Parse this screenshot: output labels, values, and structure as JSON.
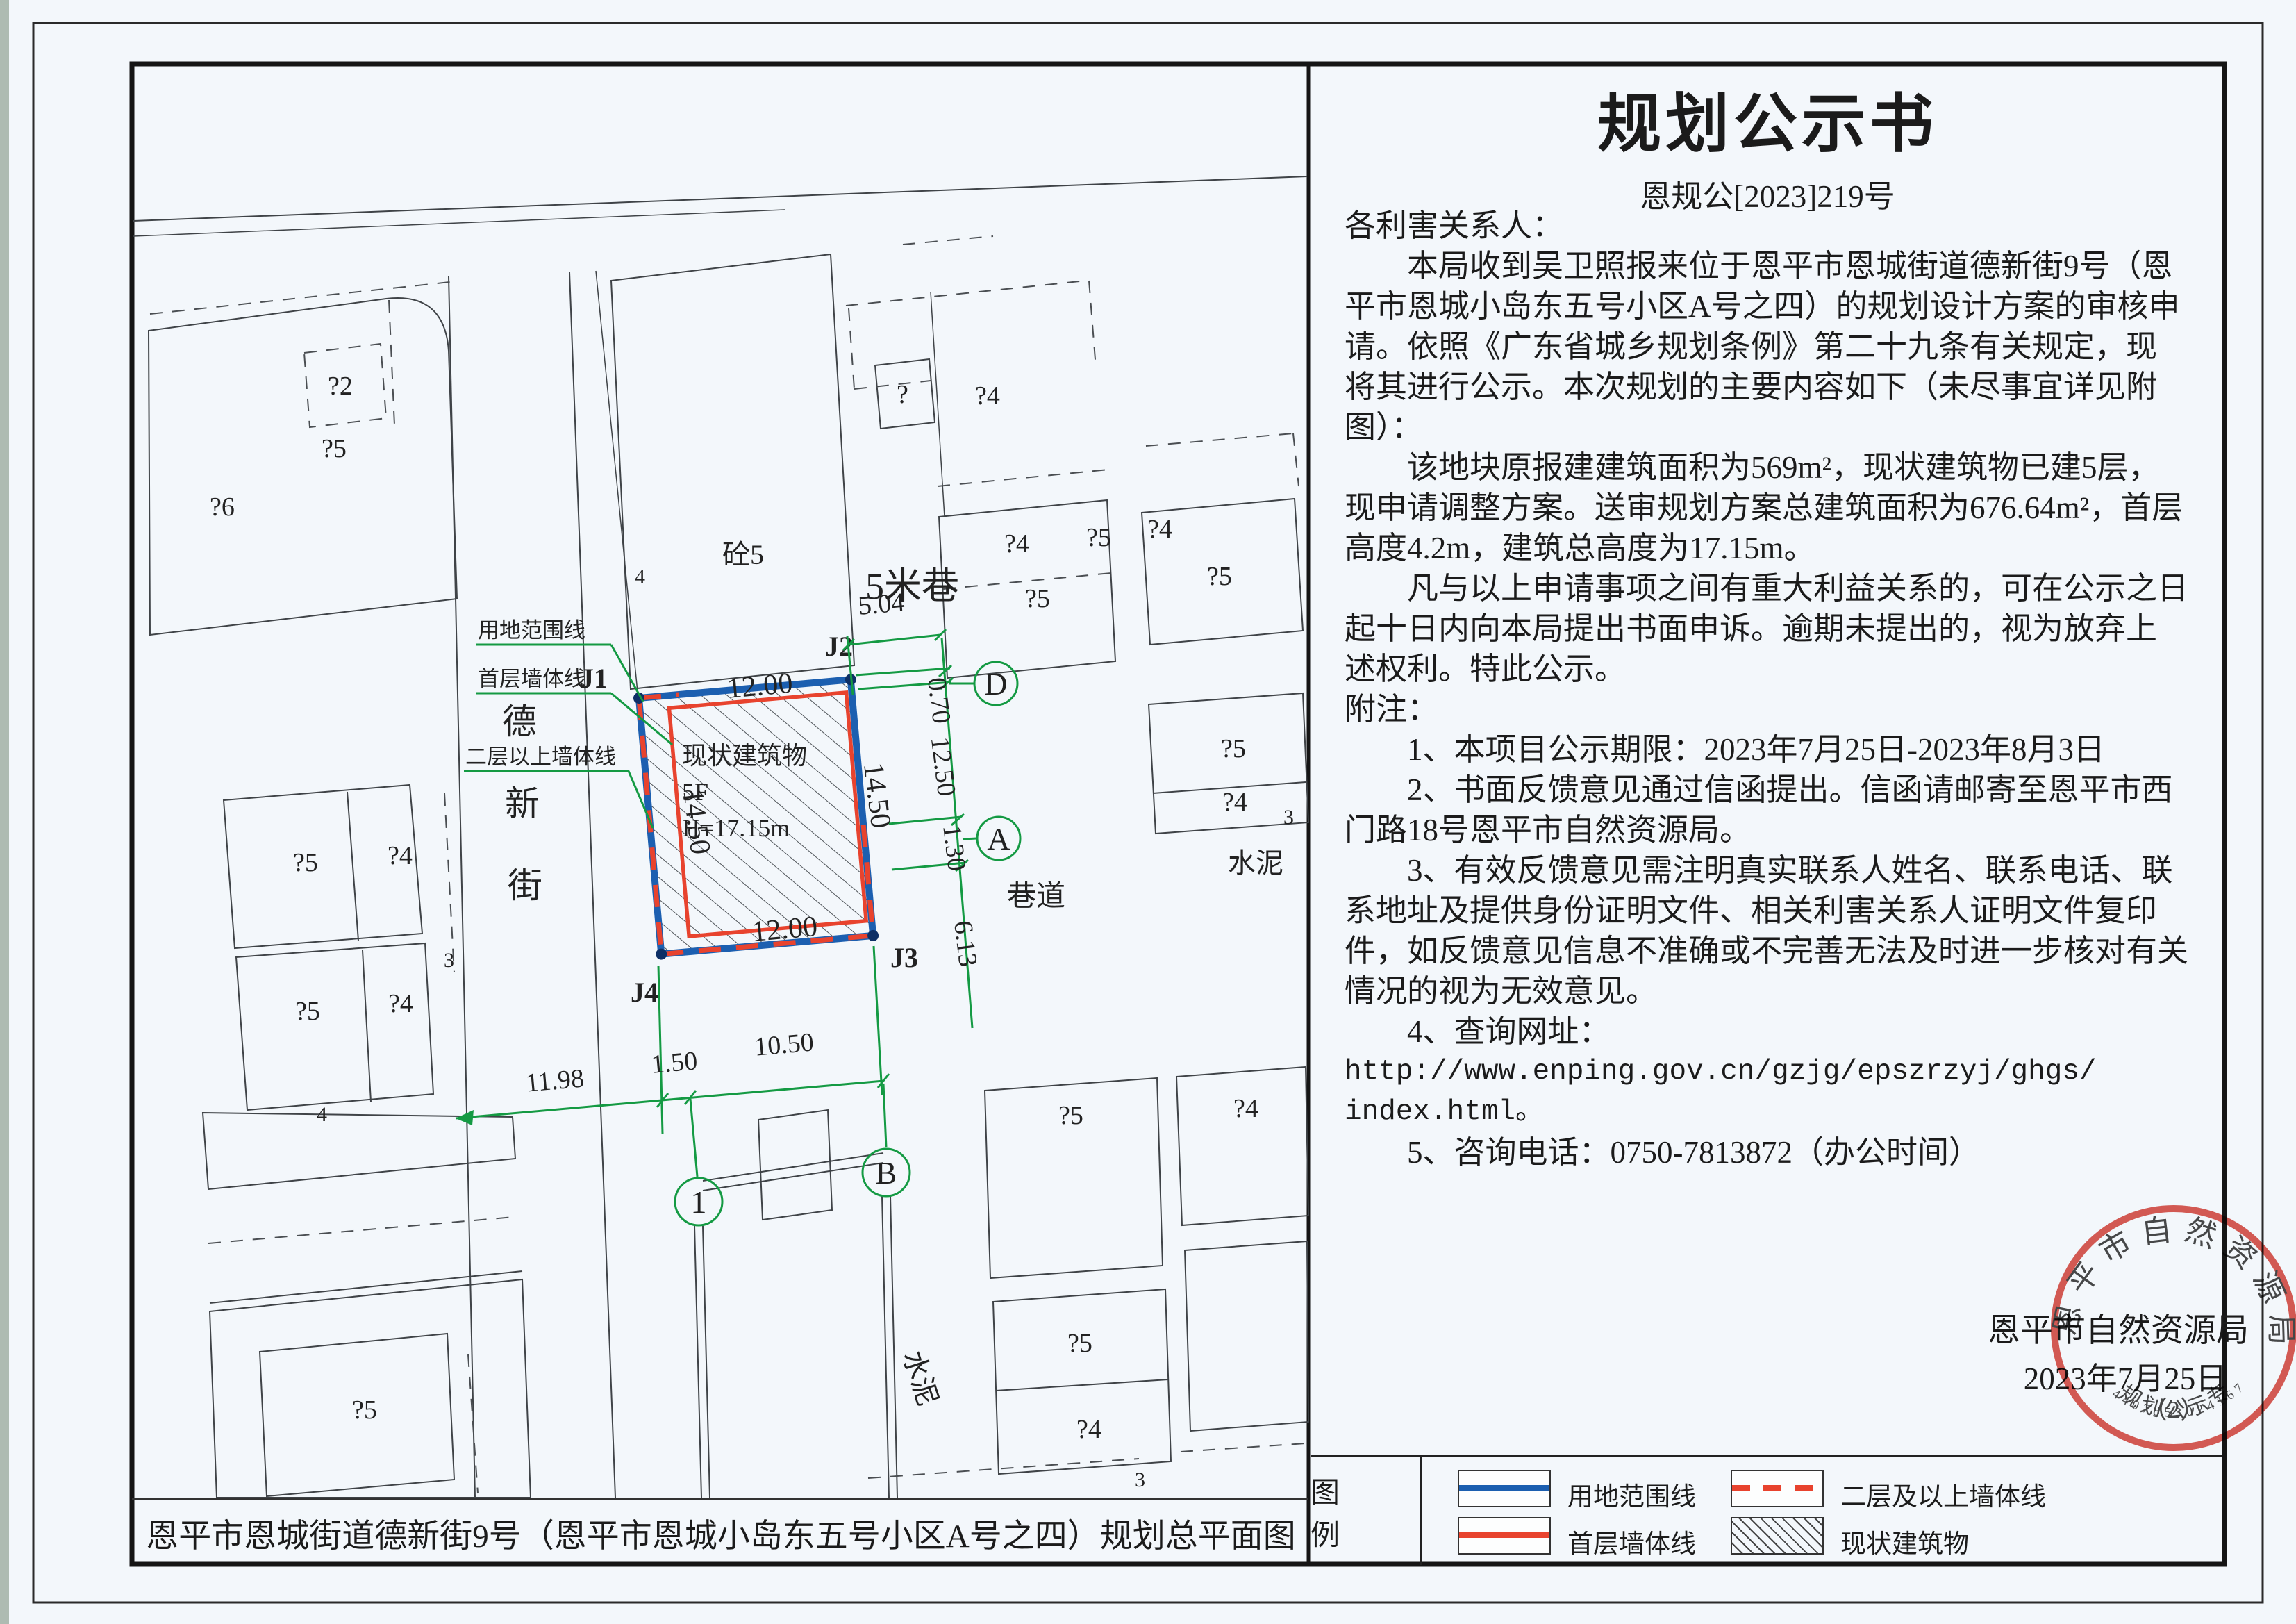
{
  "notice": {
    "title": "规划公示书",
    "doc_no": "恩规公[2023]219号",
    "body_lines": [
      "各利害关系人：",
      "　　本局收到吴卫照报来位于恩平市恩城街道德新街9号（恩",
      "平市恩城小岛东五号小区A号之四）的规划设计方案的审核申",
      "请。依照《广东省城乡规划条例》第二十九条有关规定，现",
      "将其进行公示。本次规划的主要内容如下（未尽事宜详见附",
      "图）：",
      "　　该地块原报建建筑面积为569m²，现状建筑物已建5层，",
      "现申请调整方案。送审规划方案总建筑面积为676.64m²，首层",
      "高度4.2m，建筑总高度为17.15m。",
      "　　凡与以上申请事项之间有重大利益关系的，可在公示之日",
      "起十日内向本局提出书面申诉。逾期未提出的，视为放弃上",
      "述权利。特此公示。",
      "附注：",
      "　　1、本项目公示期限：2023年7月25日-2023年8月3日",
      "　　2、书面反馈意见通过信函提出。信函请邮寄至恩平市西",
      "门路18号恩平市自然资源局。",
      "　　3、有效反馈意见需注明真实联系人姓名、联系电话、联",
      "系地址及提供身份证明文件、相关利害关系人证明文件复印",
      "件，如反馈意见信息不准确或不完善无法及时进一步核对有关",
      "情况的视为无效意见。",
      "　　4、查询网址：",
      "http://www.enping.gov.cn/gzjg/epszrzyj/ghgs/",
      "index.html。",
      "　　5、咨询电话：0750-7813872（办公时间）"
    ],
    "signature": "恩平市自然资源局",
    "date": "2023年7月25日"
  },
  "stamp": {
    "ring_text": "恩平市自然资源局",
    "inner_text": "规划公示专用章",
    "number": "（2）",
    "serial": "4407853024167"
  },
  "legend": {
    "heading": "图　例",
    "items": [
      {
        "label": "用地范围线"
      },
      {
        "label": "二层及以上墙体线"
      },
      {
        "label": "首层墙体线"
      },
      {
        "label": "现状建筑物"
      }
    ],
    "colors": {
      "boundary_blue": "#1c5fb0",
      "wall_red": "#e8432e",
      "dim_green": "#149a43"
    }
  },
  "page": {
    "bottom_title": "恩平市恩城街道德新街9号（恩平市恩城小岛东五号小区A号之四）规划总平面图"
  },
  "drawing": {
    "plot": [
      "现状建筑物",
      "5F",
      "H=17.15m"
    ],
    "j_labels": [
      "J1",
      "J2",
      "J3",
      "J4"
    ],
    "red_dims": {
      "top": "12.00",
      "bottom": "12.00",
      "left": "14.50",
      "right": "14.50"
    },
    "green_dims": {
      "lane": "5.04",
      "g070": "0.70",
      "g1250": "12.50",
      "g130": "1.30",
      "g613": "6.13",
      "g1198": "11.98",
      "g150": "1.50",
      "g1050": "10.50"
    },
    "axis_circles": [
      "D",
      "A",
      "1",
      "B"
    ],
    "leaders": [
      "用地范围线",
      "首层墙体线",
      "二层以上墙体线"
    ],
    "street_name": [
      "德",
      "新",
      "街"
    ],
    "misc": {
      "concrete": "砼5",
      "lane": "5米巷",
      "alley": "巷道",
      "cement1": "水泥",
      "cement2": "水泥"
    },
    "building_labels": [
      "?2",
      "?5",
      "?6",
      "?",
      "?4",
      "?5",
      "?4",
      "?5",
      "?4",
      "?5",
      "?5",
      "?4",
      "?5",
      "?4",
      "?5",
      "?4",
      "?5",
      "?4",
      "?5",
      "?4",
      "?5"
    ],
    "number_labels": [
      "4",
      "4",
      "3",
      "3",
      "3"
    ]
  }
}
